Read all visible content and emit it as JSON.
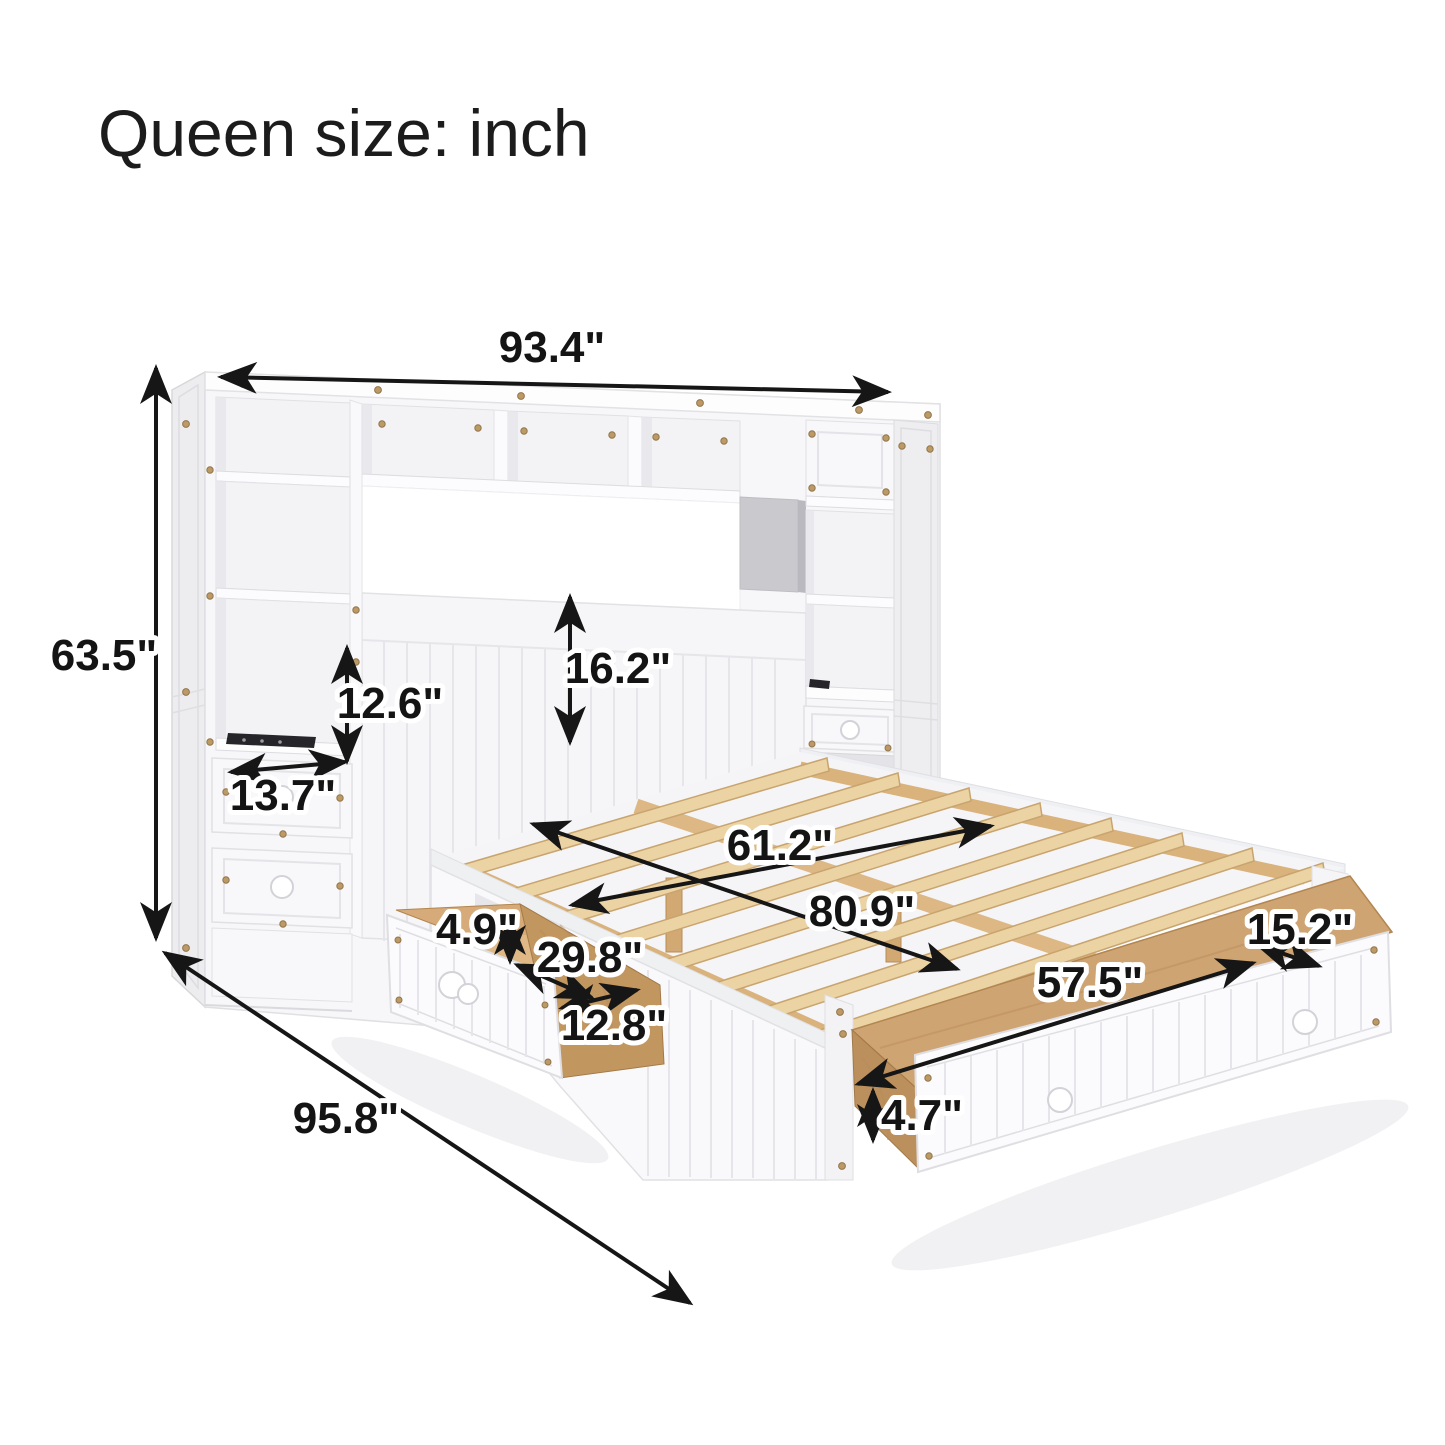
{
  "title": "Queen size: inch",
  "diagram": {
    "kind": "furniture-dimension-diagram",
    "units": "inch"
  },
  "labels": {
    "overall_width": "93.4\"",
    "overall_height": "63.5\"",
    "overall_depth": "95.8\"",
    "shelf_opening_height": "12.6\"",
    "headboard_panel_height": "16.2\"",
    "nightstand_depth": "13.7\"",
    "bed_slat_width": "61.2\"",
    "bed_slat_length": "80.9\"",
    "side_drawer_height": "4.9\"",
    "side_drawer_depth": "29.8\"",
    "side_drawer_width": "12.8\"",
    "foot_drawer_length": "57.5\"",
    "foot_drawer_depth": "15.2\"",
    "foot_drawer_height": "4.7\""
  },
  "colors": {
    "background": "#ffffff",
    "dimension_lines": "#161616",
    "furniture_white": "#f8f8fa",
    "wood_slats": "#ecd3a4",
    "wood_drawer_interior": "#cfa473",
    "hardware_brass": "#bc9a66"
  }
}
